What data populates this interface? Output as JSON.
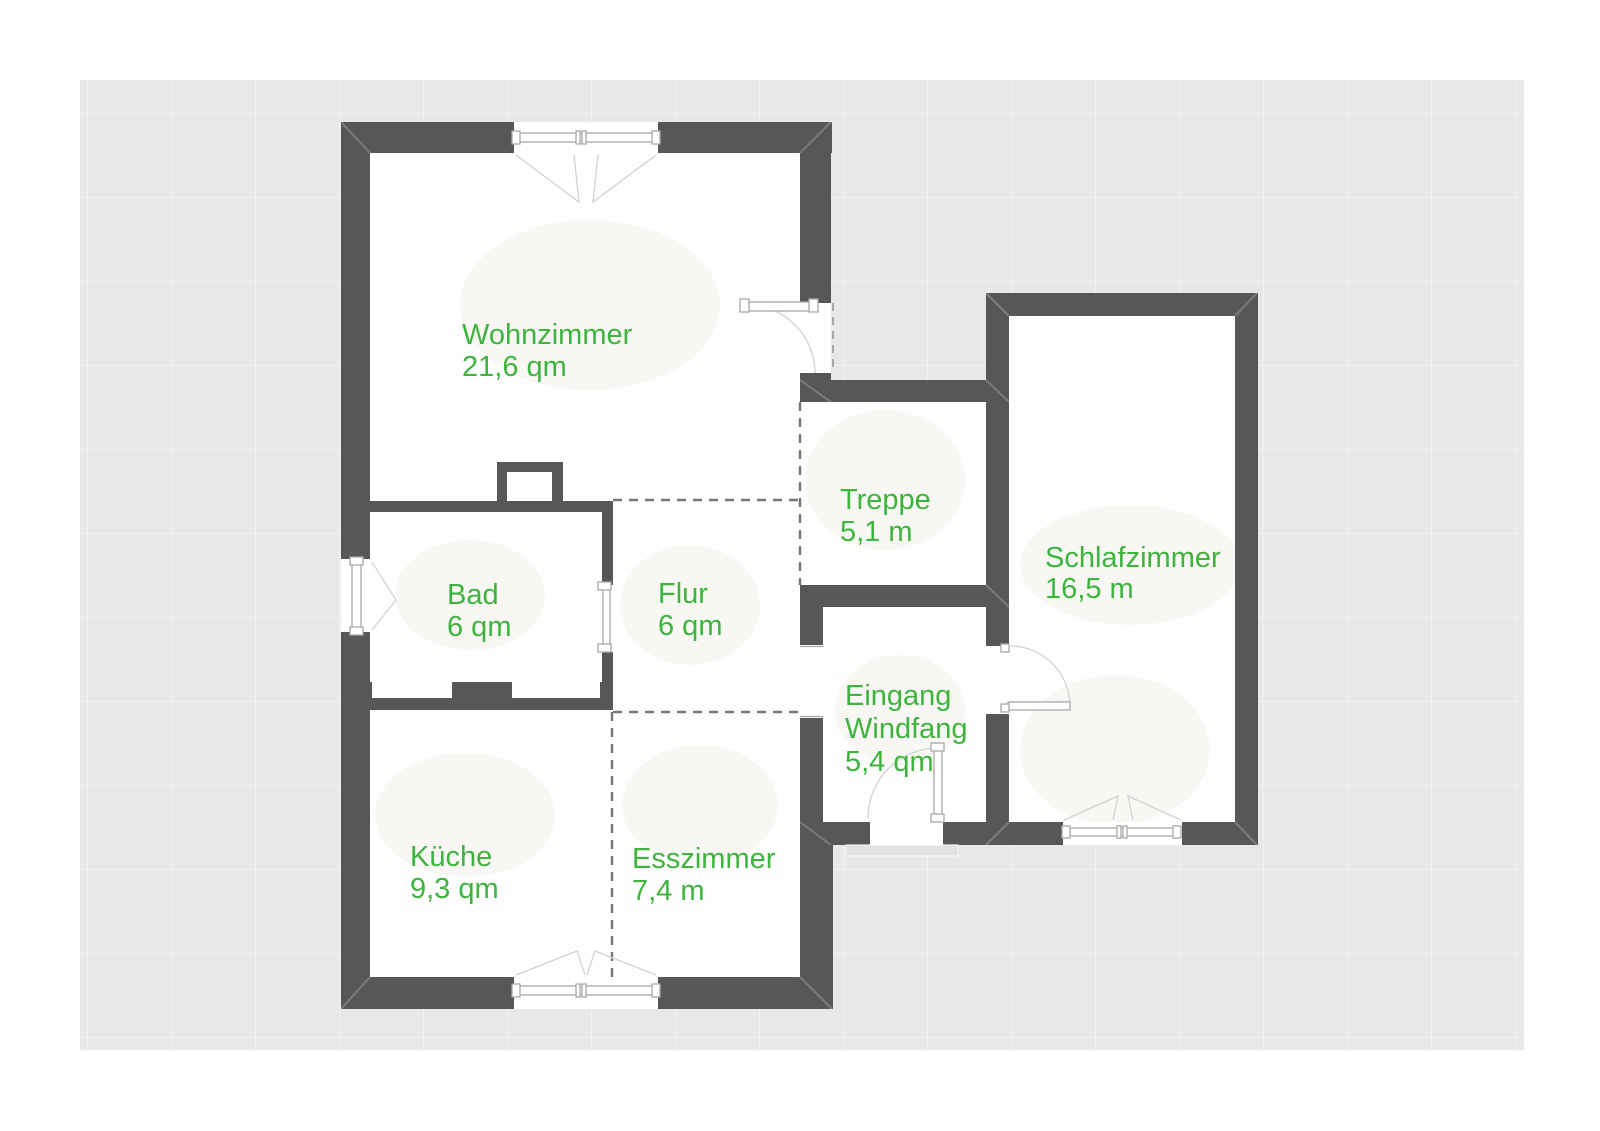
{
  "plan": {
    "type": "floor-plan",
    "colors": {
      "page": "#ffffff",
      "canvas": "#e9e8e7",
      "wall": "#575659",
      "label": "#3eb43e",
      "line": "#a8a8aa",
      "arc": "#d2d1d3",
      "dash": "#76757a"
    },
    "rooms": [
      {
        "id": "wohnzimmer",
        "name": "Wohnzimmer",
        "area": "21,6 qm"
      },
      {
        "id": "treppe",
        "name": "Treppe",
        "area": "5,1 m"
      },
      {
        "id": "schlafzimmer",
        "name": "Schlafzimmer",
        "area": "16,5 m"
      },
      {
        "id": "bad",
        "name": "Bad",
        "area": "6 qm"
      },
      {
        "id": "flur",
        "name": "Flur",
        "area": "6 qm"
      },
      {
        "id": "eingang",
        "name": "Eingang",
        "name2": "Windfang",
        "area": "5,4 qm"
      },
      {
        "id": "kueche",
        "name": "Küche",
        "area": "9,3 qm"
      },
      {
        "id": "esszimmer",
        "name": "Esszimmer",
        "area": "7,4 m"
      }
    ]
  }
}
